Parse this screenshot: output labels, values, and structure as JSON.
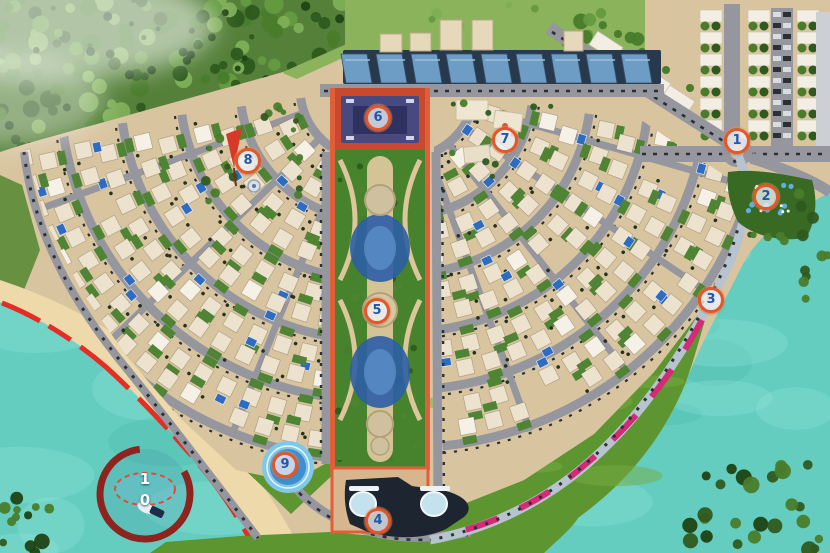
{
  "map": {
    "canvas": {
      "width": 830,
      "height": 553
    }
  },
  "markers": [
    {
      "label": "1",
      "x": 737,
      "y": 141
    },
    {
      "label": "2",
      "x": 766,
      "y": 197
    },
    {
      "label": "3",
      "x": 711,
      "y": 300
    },
    {
      "label": "4",
      "x": 378,
      "y": 521
    },
    {
      "label": "5",
      "x": 377,
      "y": 311
    },
    {
      "label": "6",
      "x": 378,
      "y": 118
    },
    {
      "label": "7",
      "x": 505,
      "y": 140
    },
    {
      "label": "8",
      "x": 248,
      "y": 161
    },
    {
      "label": "9",
      "x": 285,
      "y": 465
    }
  ],
  "marker_10": {
    "digit_top": "1",
    "digit_bottom": "0",
    "x": 145,
    "digit_top_y": 479,
    "digit_bottom_y": 500,
    "ellipse": {
      "cx": 145,
      "cy": 489,
      "rx": 30,
      "ry": 16
    }
  },
  "palette": {
    "water": "#64cdc0",
    "waterLight": "#93e4d8",
    "waterDark": "#3fae9f",
    "sand": "#d8c5a0",
    "beachSand": "#eed9ab",
    "road": "#96969e",
    "roadDash": "#2a3034",
    "forestBase": "#55803a",
    "tree1": "#2f5a1e",
    "tree2": "#497c2b",
    "tree3": "#659a40",
    "treeLight": "#7fae57",
    "grass": "#8ab35b",
    "lawn": "#5d9530",
    "lawnLight": "#76ab42",
    "villa": "#ece2cd",
    "villaAlt": "#f6f1e6",
    "garden": "#4e8433",
    "pool": "#2d6cc0",
    "blueRoof": "#6d9cc4",
    "blueRoofDark": "#27394d",
    "parkGreen": "#47822c",
    "parkPath": "#dcc69b",
    "parkBorder": "#e05e3a",
    "pond": "#2d5ea6",
    "pondLight": "#5a8fc8",
    "boardwalkRed": "#e42d24",
    "promenadePink": "#d42a78",
    "promenade": "#b7c3cf",
    "building6": "#474a7e",
    "building6Inner": "#2f3260",
    "plaza6": "#c9492d",
    "building4": "#1d2531",
    "dome": "#c4e2ee",
    "plaza4": "#d7b68e",
    "markerRing": "#e2572b",
    "markerText": "#2456a8",
    "markerFill": "rgba(238,244,248,0.78)",
    "marinaArc": "#8d2420",
    "marinaDash": "#e64a35",
    "sail": "#d83828"
  }
}
